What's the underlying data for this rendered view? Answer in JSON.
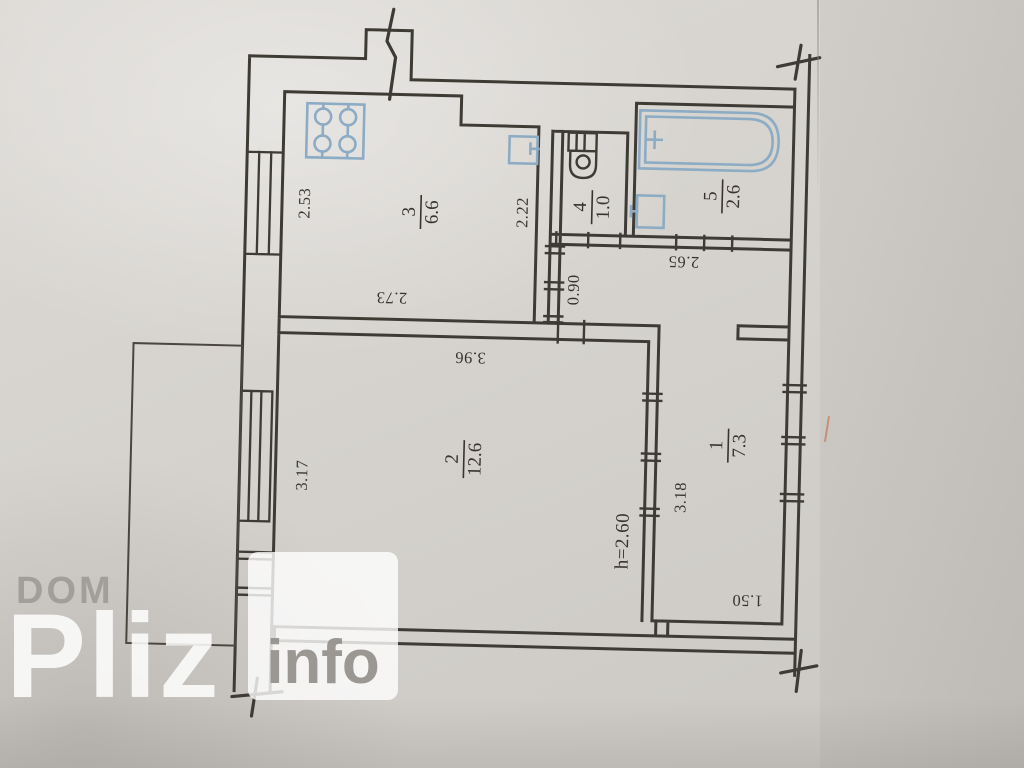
{
  "watermark": {
    "brand_top": "DOM",
    "brand_main": "Pliz",
    "brand_suffix": "info"
  },
  "rooms": [
    {
      "number": "1",
      "area": "7.3"
    },
    {
      "number": "2",
      "area": "12.6"
    },
    {
      "number": "3",
      "area": "6.6"
    },
    {
      "number": "4",
      "area": "1.0"
    },
    {
      "number": "5",
      "area": "2.6"
    }
  ],
  "dimensions": {
    "kitchen_width": "2.53",
    "kitchen_depth": "2.73",
    "kitchen_inner": "2.22",
    "corridor_width": "0.90",
    "bath_block": "2.65",
    "room2_top": "3.96",
    "room2_side": "3.17",
    "hall_side": "3.18",
    "hall_bottom": "1.50"
  },
  "notes": {
    "ceiling_height": "h=2.60"
  },
  "fixture_icons": [
    "stove-icon",
    "kitchen-sink-icon",
    "toilet-icon",
    "bathtub-icon",
    "bath-sink-icon"
  ],
  "colors": {
    "ink": "#3e3a34",
    "fixture_blue": "#8cabc4",
    "note_blue": "#6d92b6",
    "paper": "#d6d3ce",
    "watermark_gray": "#9e9a95",
    "watermark_white": "#fdfdfc"
  }
}
